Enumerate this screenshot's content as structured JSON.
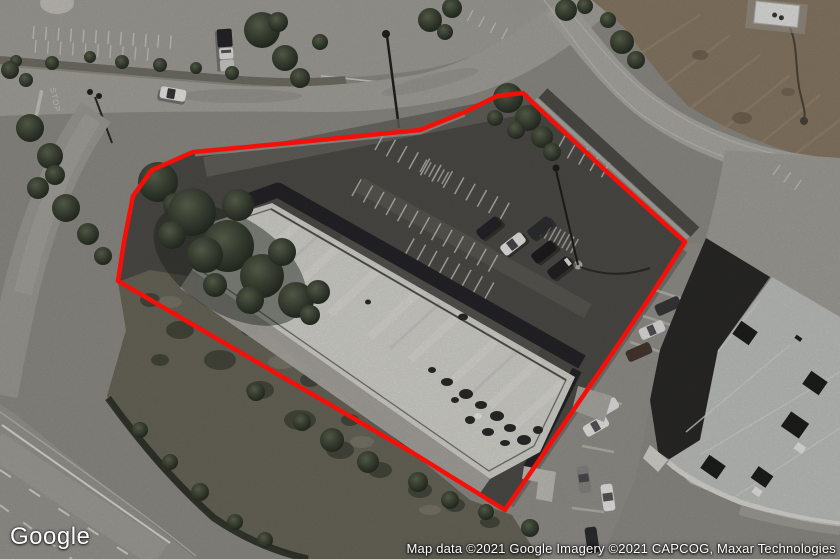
{
  "map": {
    "view_type": "satellite",
    "logo_text": "Google",
    "attribution_text": "Map data ©2021 Google Imagery ©2021 CAPCOG, Maxar Technologies",
    "road_marking_text": "STOP"
  },
  "parcel": {
    "outline_color": "#f41009",
    "outline_width": "4.5",
    "points": "497,96 523,93 533,103 605,170 685,242 650,297 618,345 505,510 413,453 118,281 124,242 133,196 152,170 193,152 300,142 420,130 465,112"
  },
  "palette": {
    "parcel_outline": "#f41009",
    "subject_lot_asphalt": "#504e49",
    "subject_roof": "#dcdbd6",
    "neighbor_roof": "#c6c8c5",
    "dirt_field": "#8d7d68",
    "road": "#aaa8a2",
    "scrub": "#6d6b5e",
    "tree_dark": "#2b3026"
  }
}
